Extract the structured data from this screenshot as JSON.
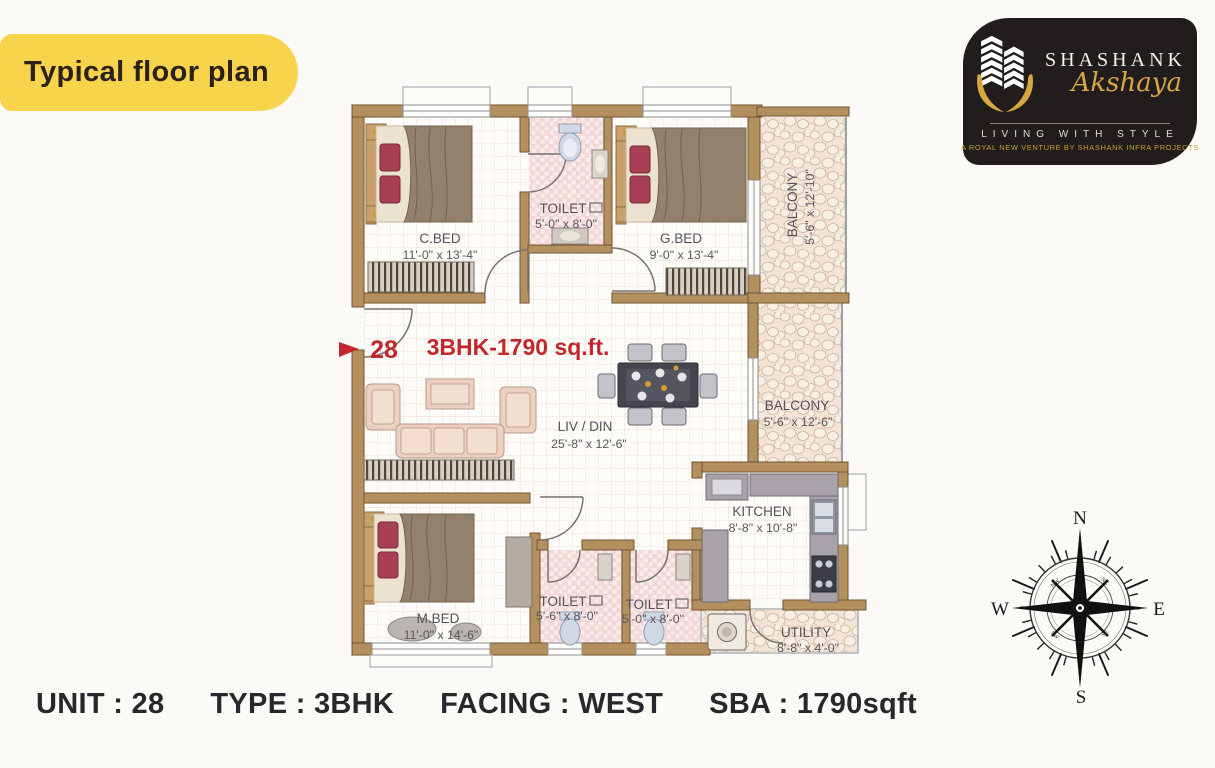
{
  "header": {
    "badge": {
      "label": "Typical floor plan",
      "bg": "#f8d44c",
      "text_color": "#2b2118"
    }
  },
  "logo": {
    "brand_top": "SHASHANK",
    "brand_script": "Akshaya",
    "tagline": "LIVING WITH STYLE",
    "subtext": "A ROYAL NEW VENTURE BY SHASHANK INFRA PROJECTS",
    "bg": "#201d1c",
    "gold": "#d8a63e"
  },
  "floor_plan": {
    "unit_number": "28",
    "area_title": "3BHK-1790 sq.ft.",
    "accent_color": "#c1272d",
    "wall_color": "#b5905f",
    "rooms": {
      "c_bed": {
        "name": "C.BED",
        "dims": "11'-0\" x 13'-4\""
      },
      "toilet_top": {
        "name": "TOILET",
        "dims": "5'-0\" x 8'-0\""
      },
      "g_bed": {
        "name": "G.BED",
        "dims": "9'-0\" x 13'-4\""
      },
      "balcony_top": {
        "name": "BALCONY",
        "dims": "5'-6\" x 12'-10\""
      },
      "liv_din": {
        "name": "LIV / DIN",
        "dims": "25'-8\" x 12'-6\""
      },
      "balcony_mid": {
        "name": "BALCONY",
        "dims": "5'-6\" x 12'-6\""
      },
      "kitchen": {
        "name": "KITCHEN",
        "dims": "8'-8\" x 10'-8\""
      },
      "m_bed": {
        "name": "M.BED",
        "dims": "11'-0\" x 14'-6\""
      },
      "toilet_1": {
        "name": "TOILET",
        "dims": "5'-6\" x 8'-0\""
      },
      "toilet_2": {
        "name": "TOILET",
        "dims": "5'-0\" x 8'-0\""
      },
      "utility": {
        "name": "UTILITY",
        "dims": "8'-8\" x 4'-0\""
      }
    }
  },
  "compass": {
    "north": "N",
    "east": "E",
    "south": "S",
    "west": "W",
    "northwest": "NW",
    "northeast": "NE",
    "southwest": "SW",
    "southeast": "SE"
  },
  "footer": {
    "items": [
      "UNIT : 28",
      "TYPE : 3BHK",
      "FACING : WEST",
      "SBA : 1790sqft"
    ]
  }
}
